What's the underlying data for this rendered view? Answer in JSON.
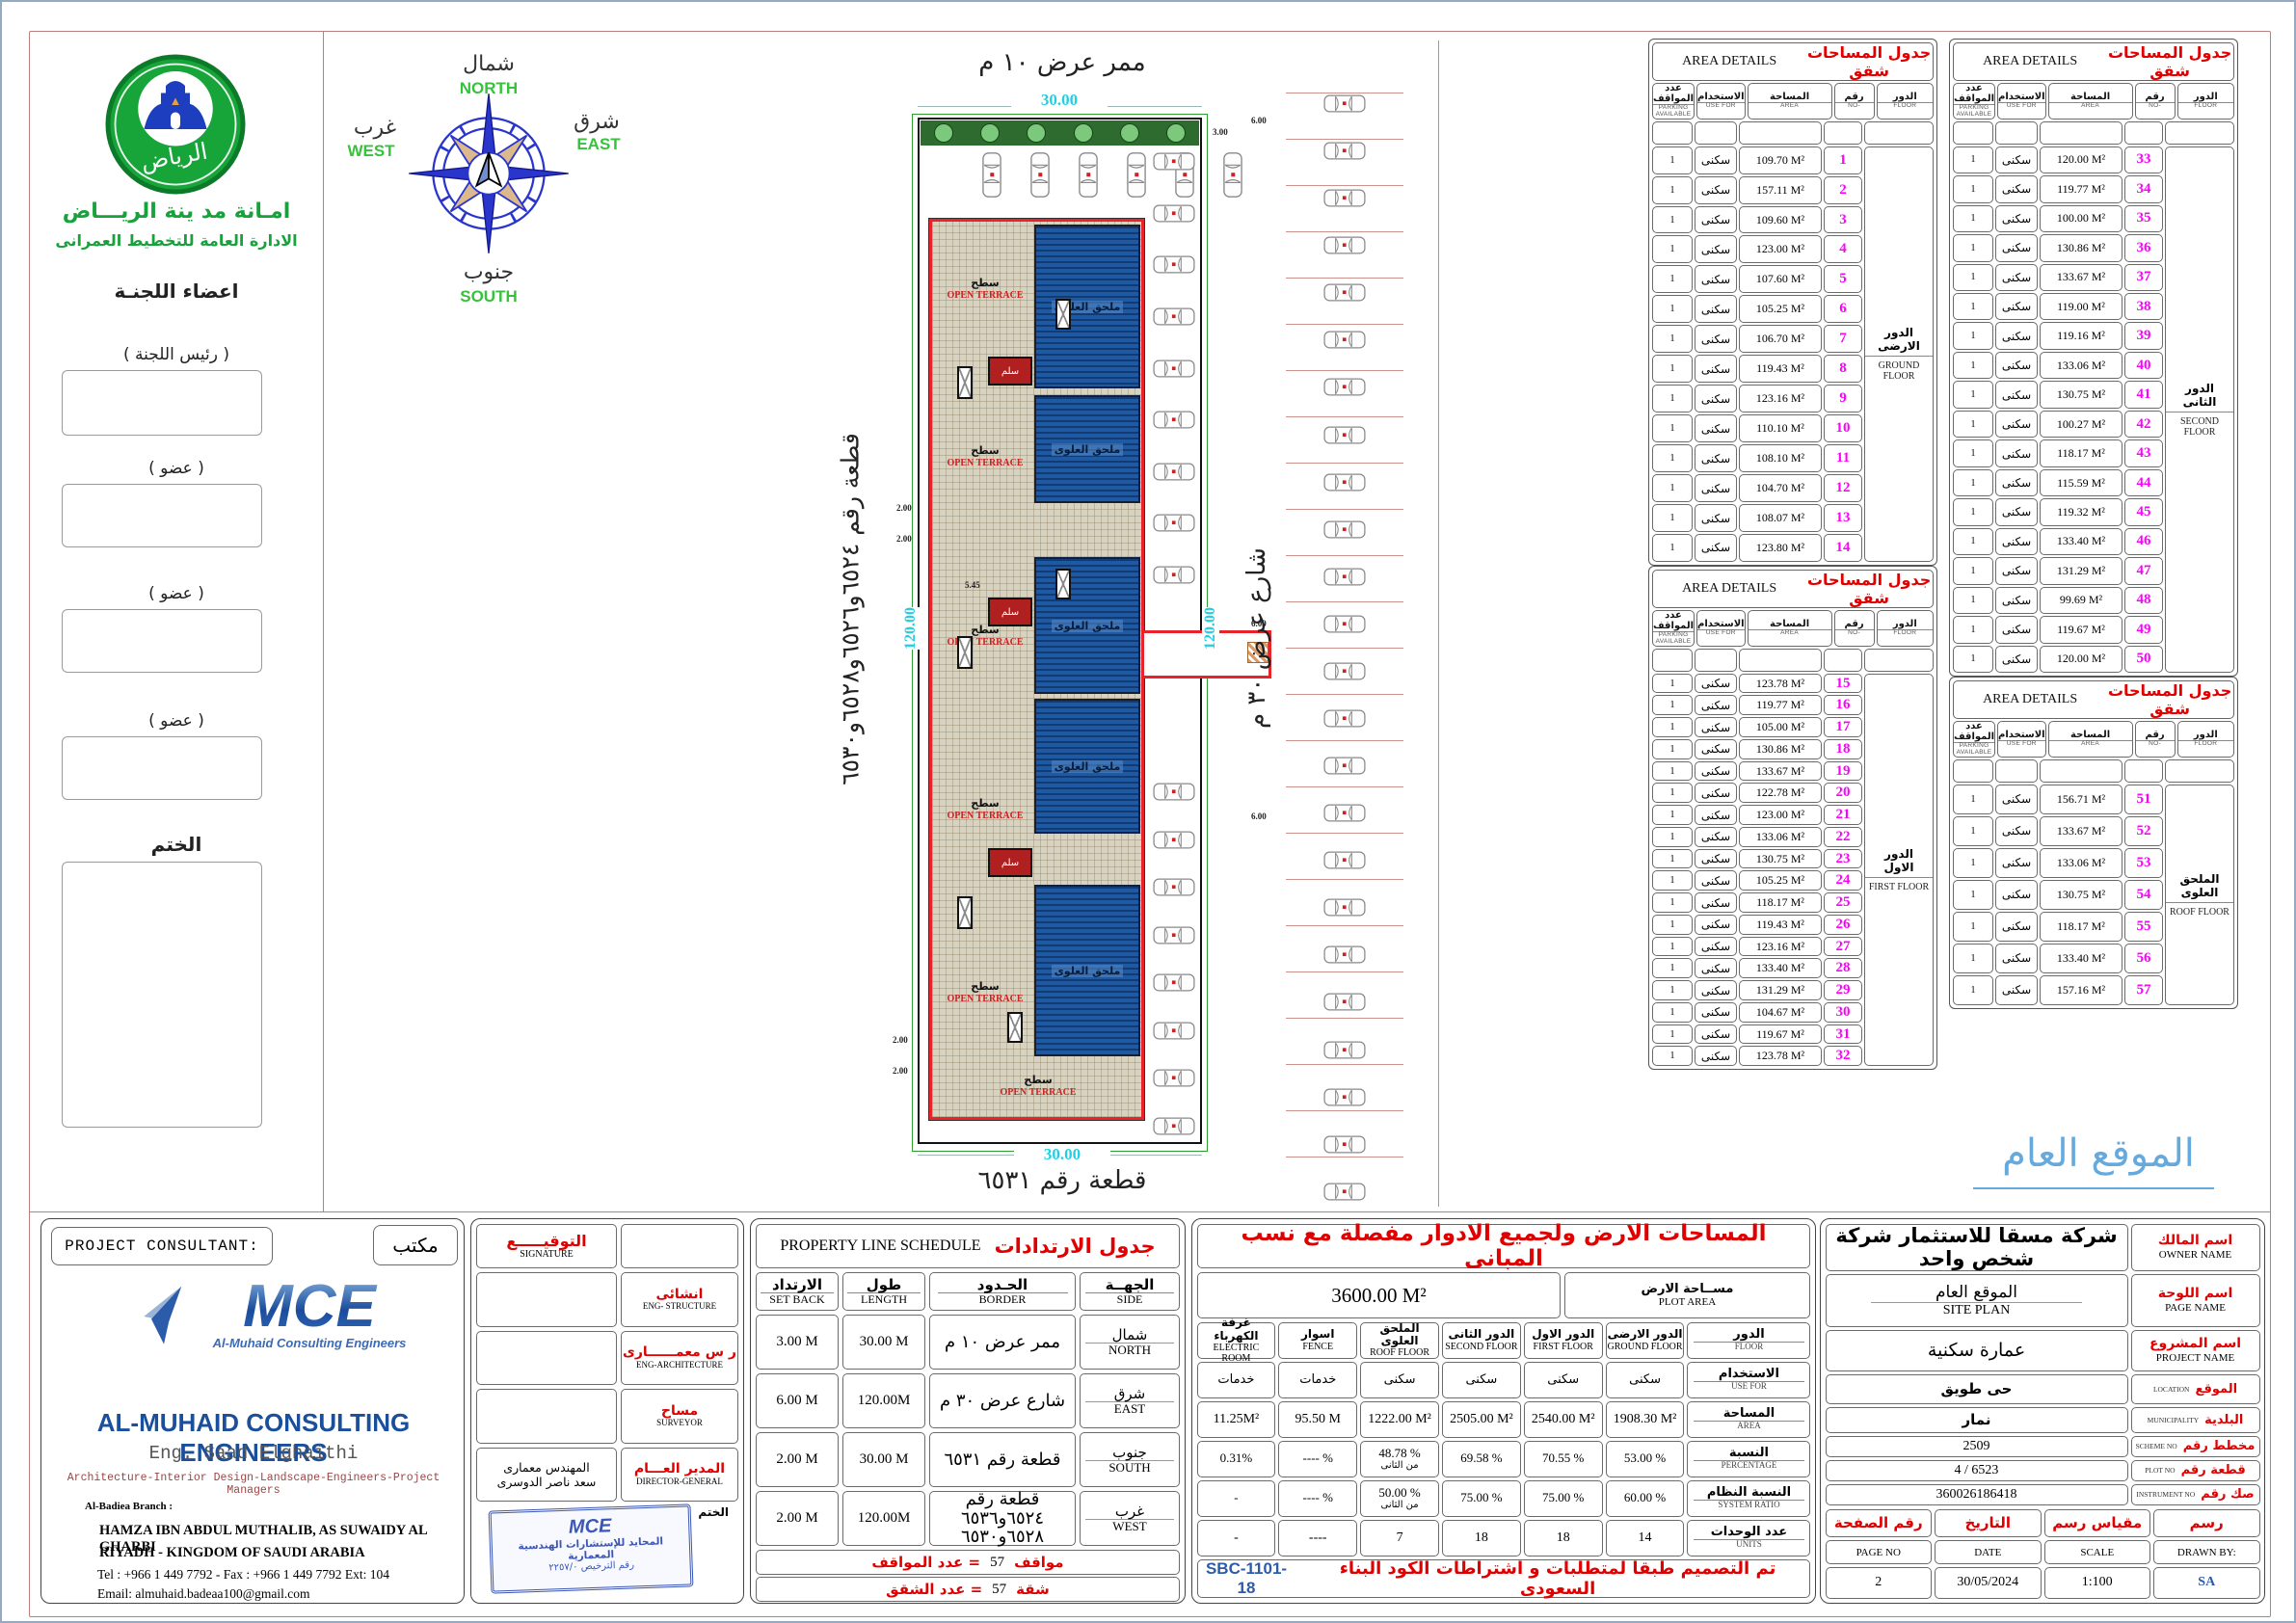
{
  "left_panel": {
    "logo_text": "الرياض",
    "authority_line1": "امـانة مد ينة الريـــاض",
    "authority_line2": "الادارة العامة للتخطيط العمرانى",
    "committee_title": "اعضاء اللجنـة",
    "chairman_label": "(  رئيس اللجنة   )",
    "member_label": "(  عضو  )",
    "stamp_label": "الختم"
  },
  "compass": {
    "north_ar": "شمال",
    "north_en": "NORTH",
    "east_ar": "شرق",
    "east_en": "EAST",
    "west_ar": "غرب",
    "west_en": "WEST",
    "south_ar": "جنوب",
    "south_en": "SOUTH"
  },
  "site_plan": {
    "top_label": "ممر عرض ١٠ م",
    "top_dim": "30.00",
    "bottom_dim": "30.00",
    "bottom_label": "قطعة رقم ٦٥٣١",
    "left_label": "قطعة رقم ٦٥٢٤و٦٥٢٦و٦٥٢٨و٦٥٣٠",
    "left_dim": "120.00",
    "right_dim": "120.00",
    "right_label": "شارع عرض ٣٠ م",
    "terrace_ar": "سطح",
    "terrace_en": "OPEN TERRACE",
    "roof_block_label": "ملحق العلوى",
    "stair_label": "سلم",
    "dim_2": "2.00",
    "dim_545": "5.45",
    "dim_6": "6.00",
    "dim_3": "3.00",
    "parking": {
      "street_cars": 24,
      "north_cars": 6,
      "inner_top_cars": 9,
      "inner_bottom_cars": 8,
      "trees": 6
    }
  },
  "site_overview_label": "الموقع العام",
  "area_table_headers": {
    "parking_ar": "عدد المواقف",
    "parking_en": "PARKING AVAILABLE",
    "use_ar": "الاستخدام",
    "use_en": "USE FOR",
    "area_ar": "المساحة",
    "area_en": "AREA",
    "no_ar": "رقم",
    "no_en": "NO-",
    "floor_ar": "الدور",
    "floor_en": "FLOOR"
  },
  "area_tables": [
    {
      "title_ar": "جدول المساحات شقق",
      "title_en": "AREA DETAILS",
      "floor_ar": "الدور الارضى",
      "floor_en": "GROUND FLOOR",
      "use": "سكنى",
      "parking": "1",
      "rows": [
        {
          "no": 1,
          "area": "109.70"
        },
        {
          "no": 2,
          "area": "157.11"
        },
        {
          "no": 3,
          "area": "109.60"
        },
        {
          "no": 4,
          "area": "123.00"
        },
        {
          "no": 5,
          "area": "107.60"
        },
        {
          "no": 6,
          "area": "105.25"
        },
        {
          "no": 7,
          "area": "106.70"
        },
        {
          "no": 8,
          "area": "119.43"
        },
        {
          "no": 9,
          "area": "123.16"
        },
        {
          "no": 10,
          "area": "110.10"
        },
        {
          "no": 11,
          "area": "108.10"
        },
        {
          "no": 12,
          "area": "104.70"
        },
        {
          "no": 13,
          "area": "108.07"
        },
        {
          "no": 14,
          "area": "123.80"
        }
      ]
    },
    {
      "title_ar": "جدول المساحات شقق",
      "title_en": "AREA DETAILS",
      "floor_ar": "الدور الاول",
      "floor_en": "FIRST FLOOR",
      "use": "سكنى",
      "parking": "1",
      "rows": [
        {
          "no": 15,
          "area": "123.78"
        },
        {
          "no": 16,
          "area": "119.77"
        },
        {
          "no": 17,
          "area": "105.00"
        },
        {
          "no": 18,
          "area": "130.86"
        },
        {
          "no": 19,
          "area": "133.67"
        },
        {
          "no": 20,
          "area": "122.78"
        },
        {
          "no": 21,
          "area": "123.00"
        },
        {
          "no": 22,
          "area": "133.06"
        },
        {
          "no": 23,
          "area": "130.75"
        },
        {
          "no": 24,
          "area": "105.25"
        },
        {
          "no": 25,
          "area": "118.17"
        },
        {
          "no": 26,
          "area": "119.43"
        },
        {
          "no": 27,
          "area": "123.16"
        },
        {
          "no": 28,
          "area": "133.40"
        },
        {
          "no": 29,
          "area": "131.29"
        },
        {
          "no": 30,
          "area": "104.67"
        },
        {
          "no": 31,
          "area": "119.67"
        },
        {
          "no": 32,
          "area": "123.78"
        }
      ]
    },
    {
      "title_ar": "جدول المساحات شقق",
      "title_en": "AREA DETAILS",
      "floor_ar": "الدور الثانى",
      "floor_en": "SECOND FLOOR",
      "use": "سكنى",
      "parking": "1",
      "rows": [
        {
          "no": 33,
          "area": "120.00"
        },
        {
          "no": 34,
          "area": "119.77"
        },
        {
          "no": 35,
          "area": "100.00"
        },
        {
          "no": 36,
          "area": "130.86"
        },
        {
          "no": 37,
          "area": "133.67"
        },
        {
          "no": 38,
          "area": "119.00"
        },
        {
          "no": 39,
          "area": "119.16"
        },
        {
          "no": 40,
          "area": "133.06"
        },
        {
          "no": 41,
          "area": "130.75"
        },
        {
          "no": 42,
          "area": "100.27"
        },
        {
          "no": 43,
          "area": "118.17"
        },
        {
          "no": 44,
          "area": "115.59"
        },
        {
          "no": 45,
          "area": "119.32"
        },
        {
          "no": 46,
          "area": "133.40"
        },
        {
          "no": 47,
          "area": "131.29"
        },
        {
          "no": 48,
          "area": "99.69"
        },
        {
          "no": 49,
          "area": "119.67"
        },
        {
          "no": 50,
          "area": "120.00"
        }
      ]
    },
    {
      "title_ar": "جدول المساحات شقق",
      "title_en": "AREA DETAILS",
      "floor_ar": "الملحق العلوى",
      "floor_en": "ROOF FLOOR",
      "use": "سكنى",
      "parking": "1",
      "rows": [
        {
          "no": 51,
          "area": "156.71"
        },
        {
          "no": 52,
          "area": "133.67"
        },
        {
          "no": 53,
          "area": "133.06"
        },
        {
          "no": 54,
          "area": "130.75"
        },
        {
          "no": 55,
          "area": "118.17"
        },
        {
          "no": 56,
          "area": "133.40"
        },
        {
          "no": 57,
          "area": "157.16"
        }
      ]
    }
  ],
  "consultant": {
    "header_en": "PROJECT  CONSULTANT:",
    "header_ar": "مكتب",
    "logo_text": "MCE",
    "logo_sub": "Al-Muhaid Consulting Engineers",
    "name_en": "AL-MUHAID CONSULTING ENGINEERS",
    "engineer": "Eng. Saad Elghaithi",
    "services": "Architecture-Interior Design-Landscape-Engineers-Project Managers",
    "branch": "Al-Badiea Branch :",
    "address1": "HAMZA IBN ABDUL MUTHALIB, AS SUWAIDY AL GHARBI",
    "address2": "RIYADH - KINGDOM OF SAUDI ARABIA",
    "phone": "Tel : +966 1 449 7792 -  Fax : +966 1 449 7792 Ext: 104",
    "email": "Email:   almuhaid.badeaa100@gmail.com"
  },
  "signature_block": {
    "title_ar": "التوقيـــــع",
    "title_en": "SIGNATURE",
    "rows": [
      {
        "ar": "انشائى",
        "en": "ENG- STRUCTURE"
      },
      {
        "ar": "ر س  معمــــــارى",
        "en": "ENG-ARCHITECTURE"
      },
      {
        "ar": "مساح",
        "en": "SURVEYOR"
      },
      {
        "ar": "المدير العـــام",
        "en": "DIRECTOR-GENERAL",
        "name1": "المهندس معمارى",
        "name2": "سعد ناصر الدوسرى"
      }
    ],
    "stamp_label": "الختم",
    "stamp_line1": "المحايد للإستشارات الهندسية المعمارية",
    "stamp_line2": "رقم الترخيص ٢٢٥٧/٠"
  },
  "property_schedule": {
    "title_ar": "جدول الارتدادات",
    "title_en": "PROPERTY LINE  SCHEDULE",
    "headers": {
      "setback_ar": "الارتداد",
      "setback_en": "SET BACK",
      "length_ar": "طول",
      "length_en": "LENGTH",
      "border_ar": "الحـدود",
      "border_en": "BORDER",
      "side_ar": "الجهــة",
      "side_en": "SIDE"
    },
    "rows": [
      {
        "setback": "3.00  M",
        "length": "30.00 M",
        "border": "ممر عرض ١٠ م",
        "side_ar": "شمال",
        "side_en": "NORTH"
      },
      {
        "setback": "6.00  M",
        "length": "120.00M",
        "border": "شارع عرض ٣٠ م",
        "side_ar": "شرق",
        "side_en": "EAST"
      },
      {
        "setback": "2.00  M",
        "length": "30.00  M",
        "border": "قطعة رقم ٦٥٣١",
        "side_ar": "جنوب",
        "side_en": "SOUTH"
      },
      {
        "setback": "2.00  M",
        "length": "120.00M",
        "border": "قطعة رقم ٦٥٢٤و٦٥٣٦",
        "border2": "٦٥٢٨و٦٥٣٠",
        "side_ar": "غرب",
        "side_en": "WEST"
      }
    ],
    "parking_count_label": "عدد المواقف  =",
    "parking_count": "57",
    "parking_unit": "مواقف",
    "units_count_label": "عدد الشقق  =",
    "units_count": "57",
    "units_unit": "شقة"
  },
  "ratios_table": {
    "title": "المساحات الارض ولجميع الادوار مفصلة مع نسب المبانى",
    "plot_area_value": "3600.00  M²",
    "plot_area_ar": "مســاحة الارض",
    "plot_area_en": "PLOT AREA",
    "row_labels": [
      {
        "ar": "الدور",
        "en": "FLOOR"
      },
      {
        "ar": "الاستخدام",
        "en": "USE FOR"
      },
      {
        "ar": "المساحة",
        "en": "AREA"
      },
      {
        "ar": "النسبة",
        "en": "PERCENTAGE"
      },
      {
        "ar": "النسبة النظام",
        "en": "SYSTEM RATIO"
      },
      {
        "ar": "عدد الوحدات",
        "en": "UNITS"
      }
    ],
    "columns": [
      {
        "floor_ar": "غرفة الكهرباء",
        "floor_en": "ELECTRIC ROOM",
        "use": "خدمات",
        "area": "11.25M²",
        "pct": "0.31%",
        "sys": "-",
        "units": "-"
      },
      {
        "floor_ar": "اسوار",
        "floor_en": "FENCE",
        "use": "خدمات",
        "area": "95.50  M",
        "pct": "---- %",
        "sys": "---- %",
        "units": "----"
      },
      {
        "floor_ar": "الملحق العلوى",
        "floor_en": "ROOF FLOOR",
        "use": "سكنى",
        "area": "1222.00 M²",
        "pct": "48.78 %",
        "pct2": "من الثانى",
        "sys": "50.00  %",
        "sys2": "من الثانى",
        "units": "7"
      },
      {
        "floor_ar": "الدور الثانى",
        "floor_en": "SECOND FLOOR",
        "use": "سكنى",
        "area": "2505.00  M²",
        "pct": "69.58  %",
        "sys": "75.00  %",
        "units": "18"
      },
      {
        "floor_ar": "الدور الاول",
        "floor_en": "FIRST FLOOR",
        "use": "سكنى",
        "area": "2540.00 M²",
        "pct": "70.55  %",
        "sys": "75.00  %",
        "units": "18"
      },
      {
        "floor_ar": "الدور الارضى",
        "floor_en": "GROUND FLOOR",
        "use": "سكنى",
        "area": "1908.30 M²",
        "pct": "53.00  %",
        "sys": "60.00  %",
        "units": "14"
      }
    ],
    "note_ar": "تم التصميم طبقا لمتطلبات   و اشتراطات الكود البناء السعودى",
    "note_code": "SBC-1101-18"
  },
  "info_panel": {
    "rows": [
      {
        "label_ar": "اسم المالك",
        "label_en": "OWNER NAME",
        "value": "شركة مسقا للاستثمار شركة شخص واحد",
        "cls": "big"
      },
      {
        "label_ar": "اسم اللوحة",
        "label_en": "PAGE NAME",
        "value": "الموقع  العام",
        "value2": "SITE  PLAN"
      },
      {
        "label_ar": "اسم المشروع",
        "label_en": "PROJECT NAME",
        "value": "عمارة سكنية",
        "cls": "hand"
      },
      {
        "label_ar": "الموقع",
        "label_en": "LOCATION",
        "value": "حى طويق",
        "cls": "bold",
        "inline": true
      },
      {
        "label_ar": "البلدية",
        "label_en": "MUNICIPALITY",
        "value": "نمار",
        "cls": "bold",
        "inline": true
      },
      {
        "label_ar": "مخطط رقم",
        "label_en": "SCHEME NO",
        "value": "2509",
        "inline": true
      },
      {
        "label_ar": "قطعة رقم",
        "label_en": "PLOT NO",
        "value": "4 / 6523",
        "inline": true
      },
      {
        "label_ar": "صك رقم",
        "label_en": "INSTRUMENT NO",
        "value": "360026186418",
        "inline": true
      }
    ],
    "bottom": [
      {
        "ar": "رقم الصفحة",
        "en": "PAGE NO",
        "value": "2"
      },
      {
        "ar": "التاريخ",
        "en": "DATE",
        "value": "30/05/2024"
      },
      {
        "ar": "مقياس رسم",
        "en": "SCALE",
        "value": "1:100"
      },
      {
        "ar": "رسم",
        "en": "DRAWN BY:",
        "value": "SA",
        "blue": true
      }
    ]
  }
}
